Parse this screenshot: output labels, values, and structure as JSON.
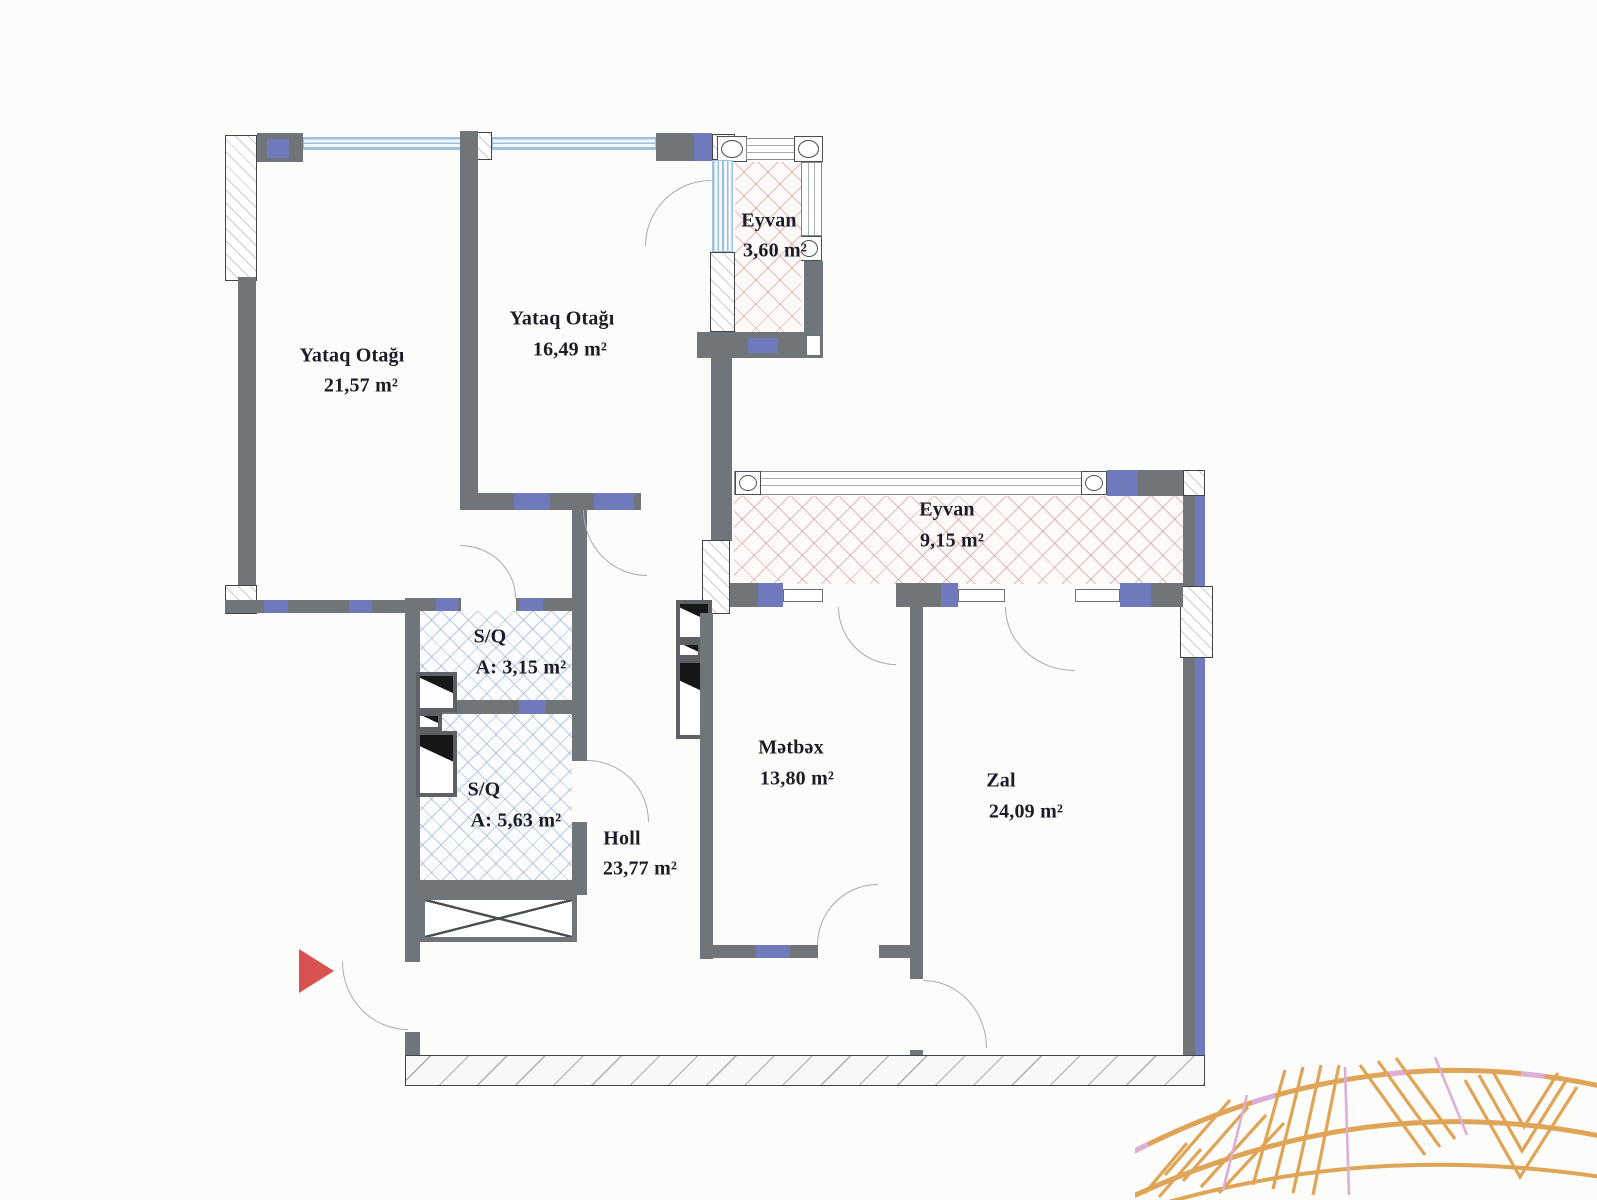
{
  "rooms": [
    {
      "name": "Yataq Otağı",
      "area": "21,57 m²"
    },
    {
      "name": "Yataq Otağı",
      "area": "16,49 m²"
    },
    {
      "name": "Eyvan",
      "area": "3,60 m²"
    },
    {
      "name": "Eyvan",
      "area": "9,15 m²"
    },
    {
      "name": "S/Q",
      "area": "A: 3,15 m²"
    },
    {
      "name": "S/Q",
      "area": "A: 5,63 m²"
    },
    {
      "name": "Holl",
      "area": "23,77 m²"
    },
    {
      "name": "Mətbəx",
      "area": "13,80 m²"
    },
    {
      "name": "Zal",
      "area": "24,09 m²"
    }
  ],
  "colors": {
    "wall": "#70757a",
    "accent": "#7079bc",
    "window": "#9fc0da",
    "balcony_hatch": "#c9847a",
    "wet_hatch": "#7d96be",
    "entrance_arrow": "#d95252",
    "decor_orange": "#dfa455",
    "decor_pink": "#dcaed8"
  }
}
